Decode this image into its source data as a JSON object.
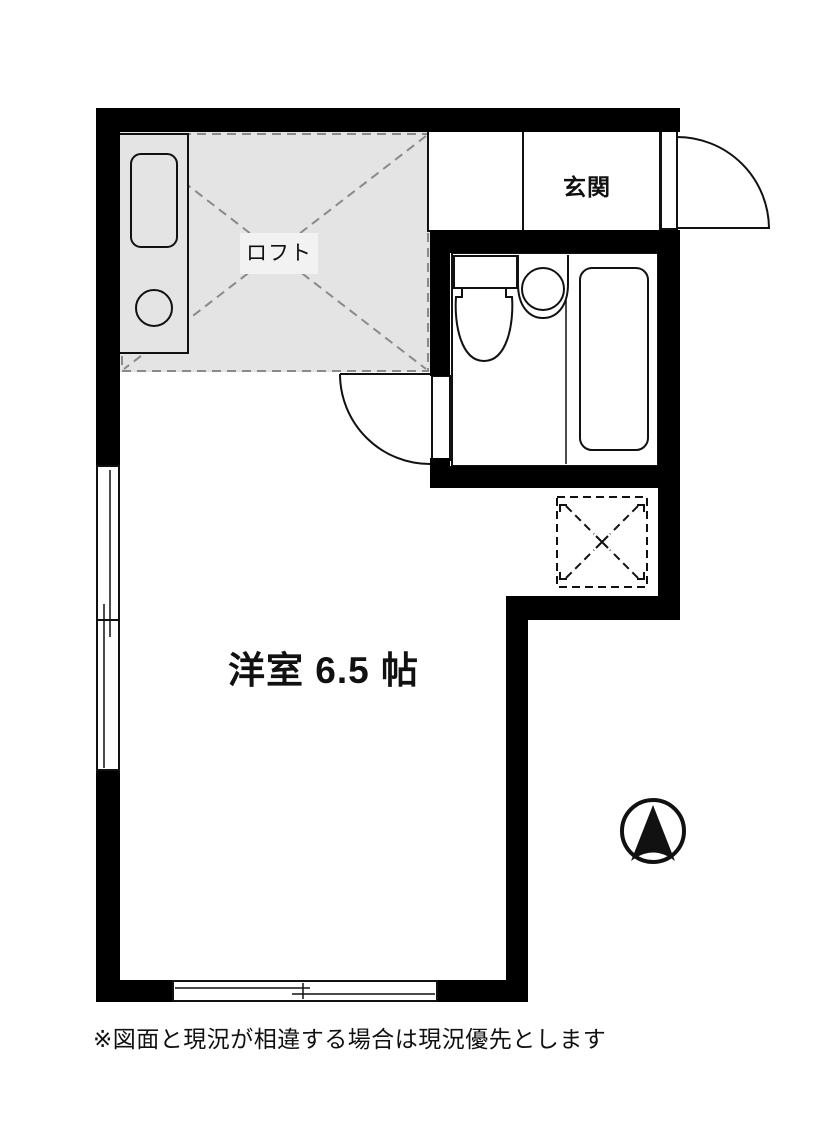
{
  "labels": {
    "loft": "ロフト",
    "entrance": "玄関",
    "main_room": "洋室 6.5 帖",
    "disclaimer": "※図面と現況が相違する場合は現況優先とします"
  },
  "colors": {
    "wall": "#000000",
    "loft_fill": "#e4e4e4",
    "dash": "#8a8a8a",
    "line": "#111111",
    "label_box": "#f2f2f2",
    "paper": "#ffffff"
  },
  "fixtures": {
    "kitchen_unit": "kitchen-counter",
    "kitchen_sink": "sink",
    "kitchen_burner": "single-burner",
    "toilet": "toilet",
    "wash_basin": "wash-basin",
    "bathtub": "bathtub",
    "entry_door": "entry-door-swing",
    "bath_door": "bath-door-swing",
    "left_window": "sliding-window",
    "bottom_window": "sliding-window",
    "hatch": "loft-hatch-opening",
    "compass": "north-arrow"
  }
}
